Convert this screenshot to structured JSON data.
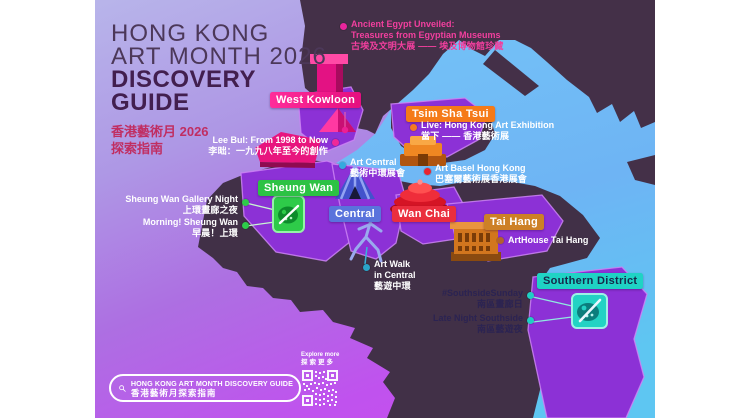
{
  "title": {
    "en_line1": "HONG KONG",
    "en_line2": "ART MONTH 2026",
    "en_line3": "DISCOVERY",
    "en_line4": "GUIDE",
    "zh_line1": "香港藝術月 2026",
    "zh_line2": "探索指南"
  },
  "districts": {
    "west_kowloon": {
      "label": "West Kowloon",
      "color": "#f01b87"
    },
    "tsim_sha_tsui": {
      "label": "Tsim Sha Tsui",
      "color": "#f57a18"
    },
    "sheung_wan": {
      "label": "Sheung Wan",
      "color": "#2cc244"
    },
    "central": {
      "label": "Central",
      "color": "#5a73dc"
    },
    "wan_chai": {
      "label": "Wan Chai",
      "color": "#ea2e3e"
    },
    "tai_hang": {
      "label": "Tai Hang",
      "color": "#cd8026"
    },
    "southern_district": {
      "label": "Southern District",
      "color": "#1fd3c4"
    }
  },
  "events": {
    "ancient_egypt": {
      "en1": "Ancient Egypt Unveiled:",
      "en2": "Treasures from Egyptian Museums",
      "zh": "古埃及文明大展 —— 埃及博物館珍藏",
      "dot_color": "#e9259c"
    },
    "live_hk_art": {
      "en": "Live: Hong Kong Art Exhibition",
      "zh": "當下 —— 香港藝術展",
      "dot_color": "#f57a20"
    },
    "lee_bul": {
      "en": "Lee Bul: From 1998 to Now",
      "zh": "李昢：一九九八年至今的創作",
      "dot_color": "#f02898"
    },
    "art_central": {
      "en": "Art Central",
      "zh": "藝術中環展會",
      "dot_color": "#35aade"
    },
    "art_basel": {
      "en": "Art Basel Hong Kong",
      "zh": "巴塞爾藝術展香港展會",
      "dot_color": "#e82430"
    },
    "sheung_wan_gallery_night": {
      "en": "Sheung Wan Gallery Night",
      "zh": "上環畫廊之夜",
      "dot_color": "#2ecc4a"
    },
    "morning_sheung_wan": {
      "en": "Morning! Sheung Wan",
      "zh": "早晨！上環",
      "dot_color": "#2ecc4a"
    },
    "arthouse_tai_hang": {
      "en": "ArtHouse Tai Hang",
      "dot_color": "#b26030"
    },
    "art_walk": {
      "en1": "Art Walk",
      "en2": "in Central",
      "zh": "藝遊中環",
      "dot_color": "#2aa4c8"
    },
    "southside_sunday": {
      "en": "#SouthsideSunday",
      "zh": "南區畫廊日",
      "dot_color": "#1fcfc4"
    },
    "late_night_southside": {
      "en": "Late Night Southside",
      "zh": "南區藝遊夜",
      "dot_color": "#1fcfc4"
    }
  },
  "search_bar": {
    "en": "HONG KONG ART MONTH DISCOVERY GUIDE",
    "zh": "香港藝術月探索指南"
  },
  "qr": {
    "en": "Explore more",
    "zh": "探索更多"
  },
  "map_colors": {
    "land_dark": "#443048",
    "district_purple": "#8c31d6",
    "district_border": "#cd84f4",
    "water_blue": "#6fc2f6",
    "background_top": "#b8b5ea",
    "background_bottom": "#ca4df1"
  }
}
